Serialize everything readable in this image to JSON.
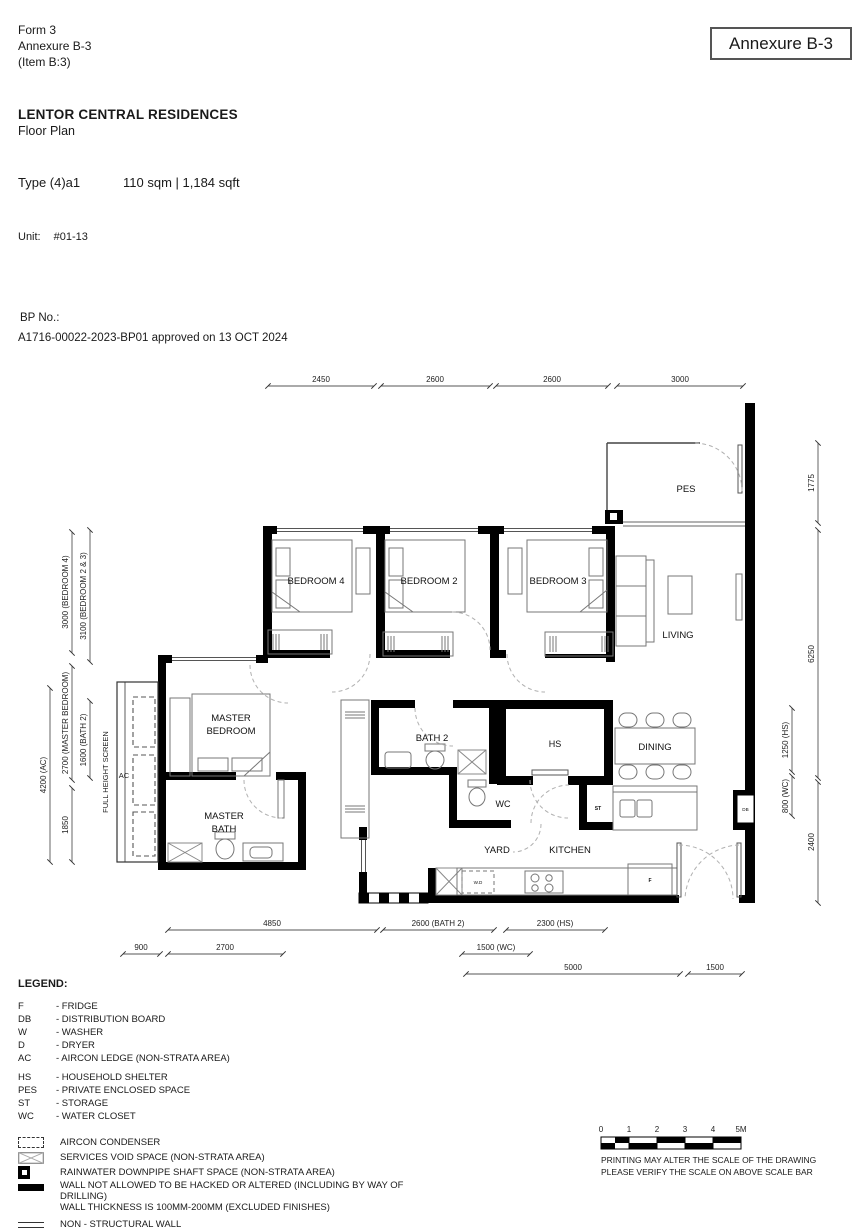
{
  "header": {
    "form": "Form 3",
    "annexure": "Annexure B-3",
    "item": "(Item B:3)",
    "annexure_box": "Annexure B-3",
    "project": "LENTOR CENTRAL RESIDENCES",
    "doc_type": "Floor Plan",
    "unit_type": "Type (4)a1",
    "area": "110 sqm | 1,184 sqft",
    "unit_label": "Unit:",
    "unit_value": "#01-13",
    "bp_label": "BP No.:",
    "bp_value": "A1716-00022-2023-BP01 approved on 13 OCT 2024"
  },
  "plan": {
    "rooms": {
      "pes": "PES",
      "living": "LIVING",
      "dining": "DINING",
      "bedroom4": "BEDROOM 4",
      "bedroom2": "BEDROOM 2",
      "bedroom3": "BEDROOM 3",
      "master_line1": "MASTER",
      "master_line2": "BEDROOM",
      "masterbath_line1": "MASTER",
      "masterbath_line2": "BATH",
      "bath2": "BATH 2",
      "hs": "HS",
      "wc": "WC",
      "yard": "YARD",
      "kitchen": "KITCHEN",
      "st": "ST",
      "ac": "AC",
      "db": "DB",
      "wd": "W.D",
      "fridge": "F",
      "full_height_screen": "FULL HEIGHT SCREEN"
    },
    "dims": {
      "top": [
        "2450",
        "2600",
        "2600",
        "3000"
      ],
      "left": [
        "3000 (BEDROOM 4)",
        "3100 (BEDROOM 2 & 3)",
        "2700 (MASTER BEDROOM)",
        "1600 (BATH 2)",
        "4200 (AC)",
        "1850"
      ],
      "right": [
        "1775",
        "6250",
        "1250 (HS)",
        "800 (WC)",
        "2400"
      ],
      "bottom": [
        "4850",
        "2600 (BATH 2)",
        "2300 (HS)",
        "900",
        "2700",
        "1500 (WC)",
        "5000",
        "1500"
      ]
    }
  },
  "legend": {
    "title": "LEGEND:",
    "abbreviations": [
      {
        "abbr": "F",
        "desc": "- FRIDGE"
      },
      {
        "abbr": "DB",
        "desc": "- DISTRIBUTION BOARD"
      },
      {
        "abbr": "W",
        "desc": "- WASHER"
      },
      {
        "abbr": "D",
        "desc": "- DRYER"
      },
      {
        "abbr": "AC",
        "desc": "- AIRCON LEDGE (NON-STRATA AREA)"
      },
      {
        "abbr": "HS",
        "desc": "- HOUSEHOLD SHELTER"
      },
      {
        "abbr": "PES",
        "desc": "- PRIVATE ENCLOSED SPACE"
      },
      {
        "abbr": "ST",
        "desc": "- STORAGE"
      },
      {
        "abbr": "WC",
        "desc": "- WATER CLOSET"
      }
    ],
    "symbols": [
      {
        "label": "AIRCON CONDENSER"
      },
      {
        "label": "SERVICES VOID SPACE (NON-STRATA AREA)"
      },
      {
        "label": "RAINWATER DOWNPIPE SHAFT SPACE (NON-STRATA AREA)"
      },
      {
        "label": "WALL NOT ALLOWED TO BE HACKED OR ALTERED (INCLUDING BY WAY OF DRILLING)",
        "label2": "WALL THICKNESS IS 100MM-200MM (EXCLUDED FINISHES)"
      },
      {
        "label": "NON - STRUCTURAL WALL"
      }
    ]
  },
  "scalebar": {
    "ticks": [
      "0",
      "1",
      "2",
      "3",
      "4",
      "5M"
    ],
    "note1": "PRINTING MAY ALTER THE SCALE OF THE DRAWING",
    "note2": "PLEASE VERIFY THE SCALE ON ABOVE SCALE BAR"
  }
}
